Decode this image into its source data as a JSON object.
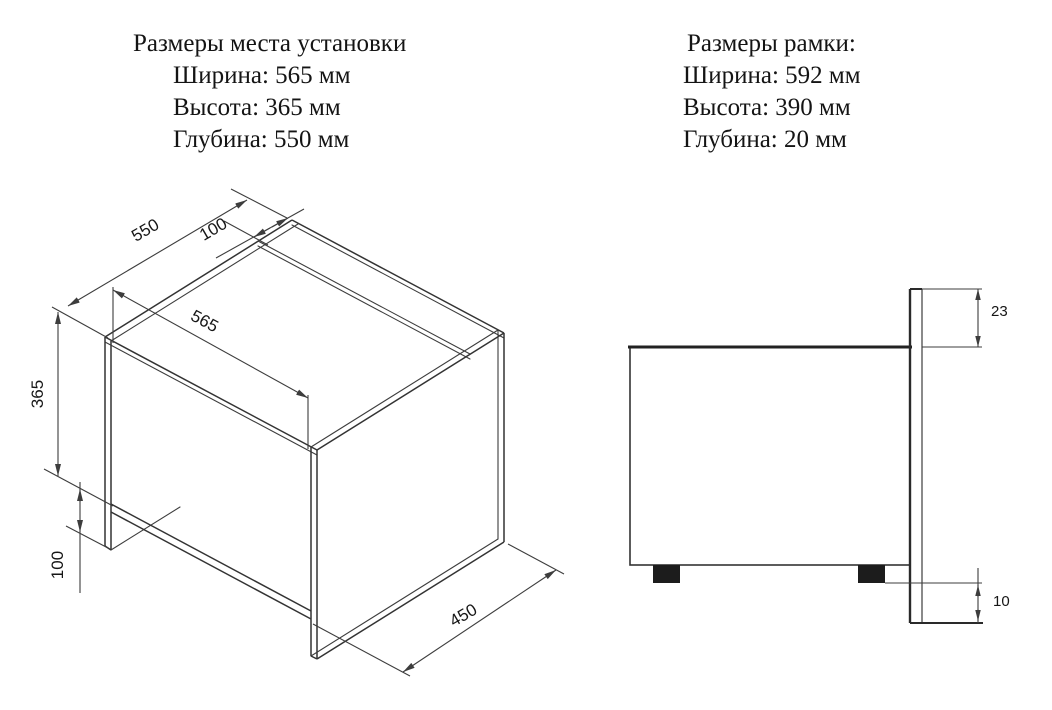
{
  "info_blocks": {
    "installation": {
      "title": "Размеры места установки",
      "lines": [
        "Ширина: 565 мм",
        "Высота: 365 мм",
        "Глубина: 550 мм"
      ]
    },
    "frame": {
      "title": "Размеры рамки:",
      "lines": [
        "Ширина: 592 мм",
        "Высота: 390 мм",
        "Глубина: 20 мм"
      ]
    }
  },
  "iso_diagram": {
    "labels": {
      "depth_550": "550",
      "top_offset_100": "100",
      "width_565": "565",
      "height_365": "365",
      "plinth_100": "100",
      "shelf_depth_450": "450"
    }
  },
  "side_diagram": {
    "labels": {
      "top_overlap_23": "23",
      "bottom_overlap_10": "10"
    }
  },
  "colors": {
    "background": "#ffffff",
    "line": "#3d3d3d",
    "line_strong": "#222222",
    "text": "#141414",
    "foot_fill": "#1c1c1c"
  }
}
